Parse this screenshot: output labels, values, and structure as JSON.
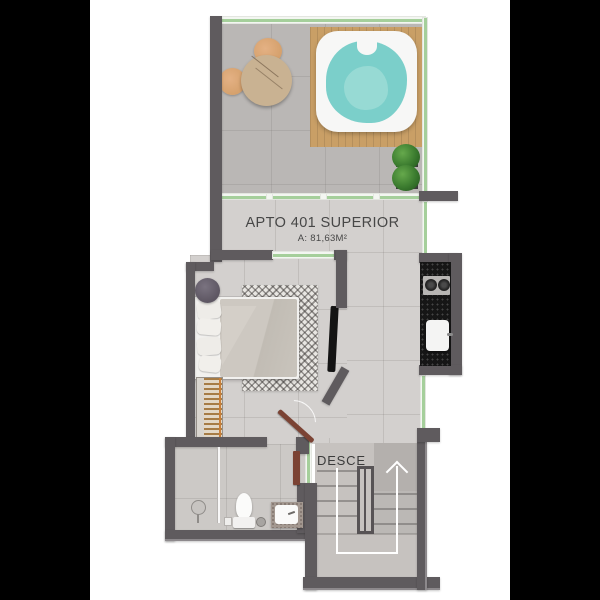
{
  "plan": {
    "title": "APTO 401 SUPERIOR",
    "area": "A: 81,63M²",
    "stairs_label": "DESCE"
  },
  "colors": {
    "background": "#000000",
    "paper": "#ffffff",
    "wall": "#5f5b5e",
    "wall_light": "#8d898c",
    "glass": "#a5cf9b",
    "floor_light": "#d3d0ce",
    "floor_terrace": "#bab7b5",
    "floor_bath": "#ccc9c6",
    "floor_stair": "#c6c2bf",
    "water": "#7bcfca",
    "wood_deck": "#c99f66",
    "door_wood": "#7b4334",
    "counter_black": "#161616",
    "plant_green": "#3a7a2e",
    "arrow_white": "#ffffff",
    "text_dark": "#474747"
  }
}
